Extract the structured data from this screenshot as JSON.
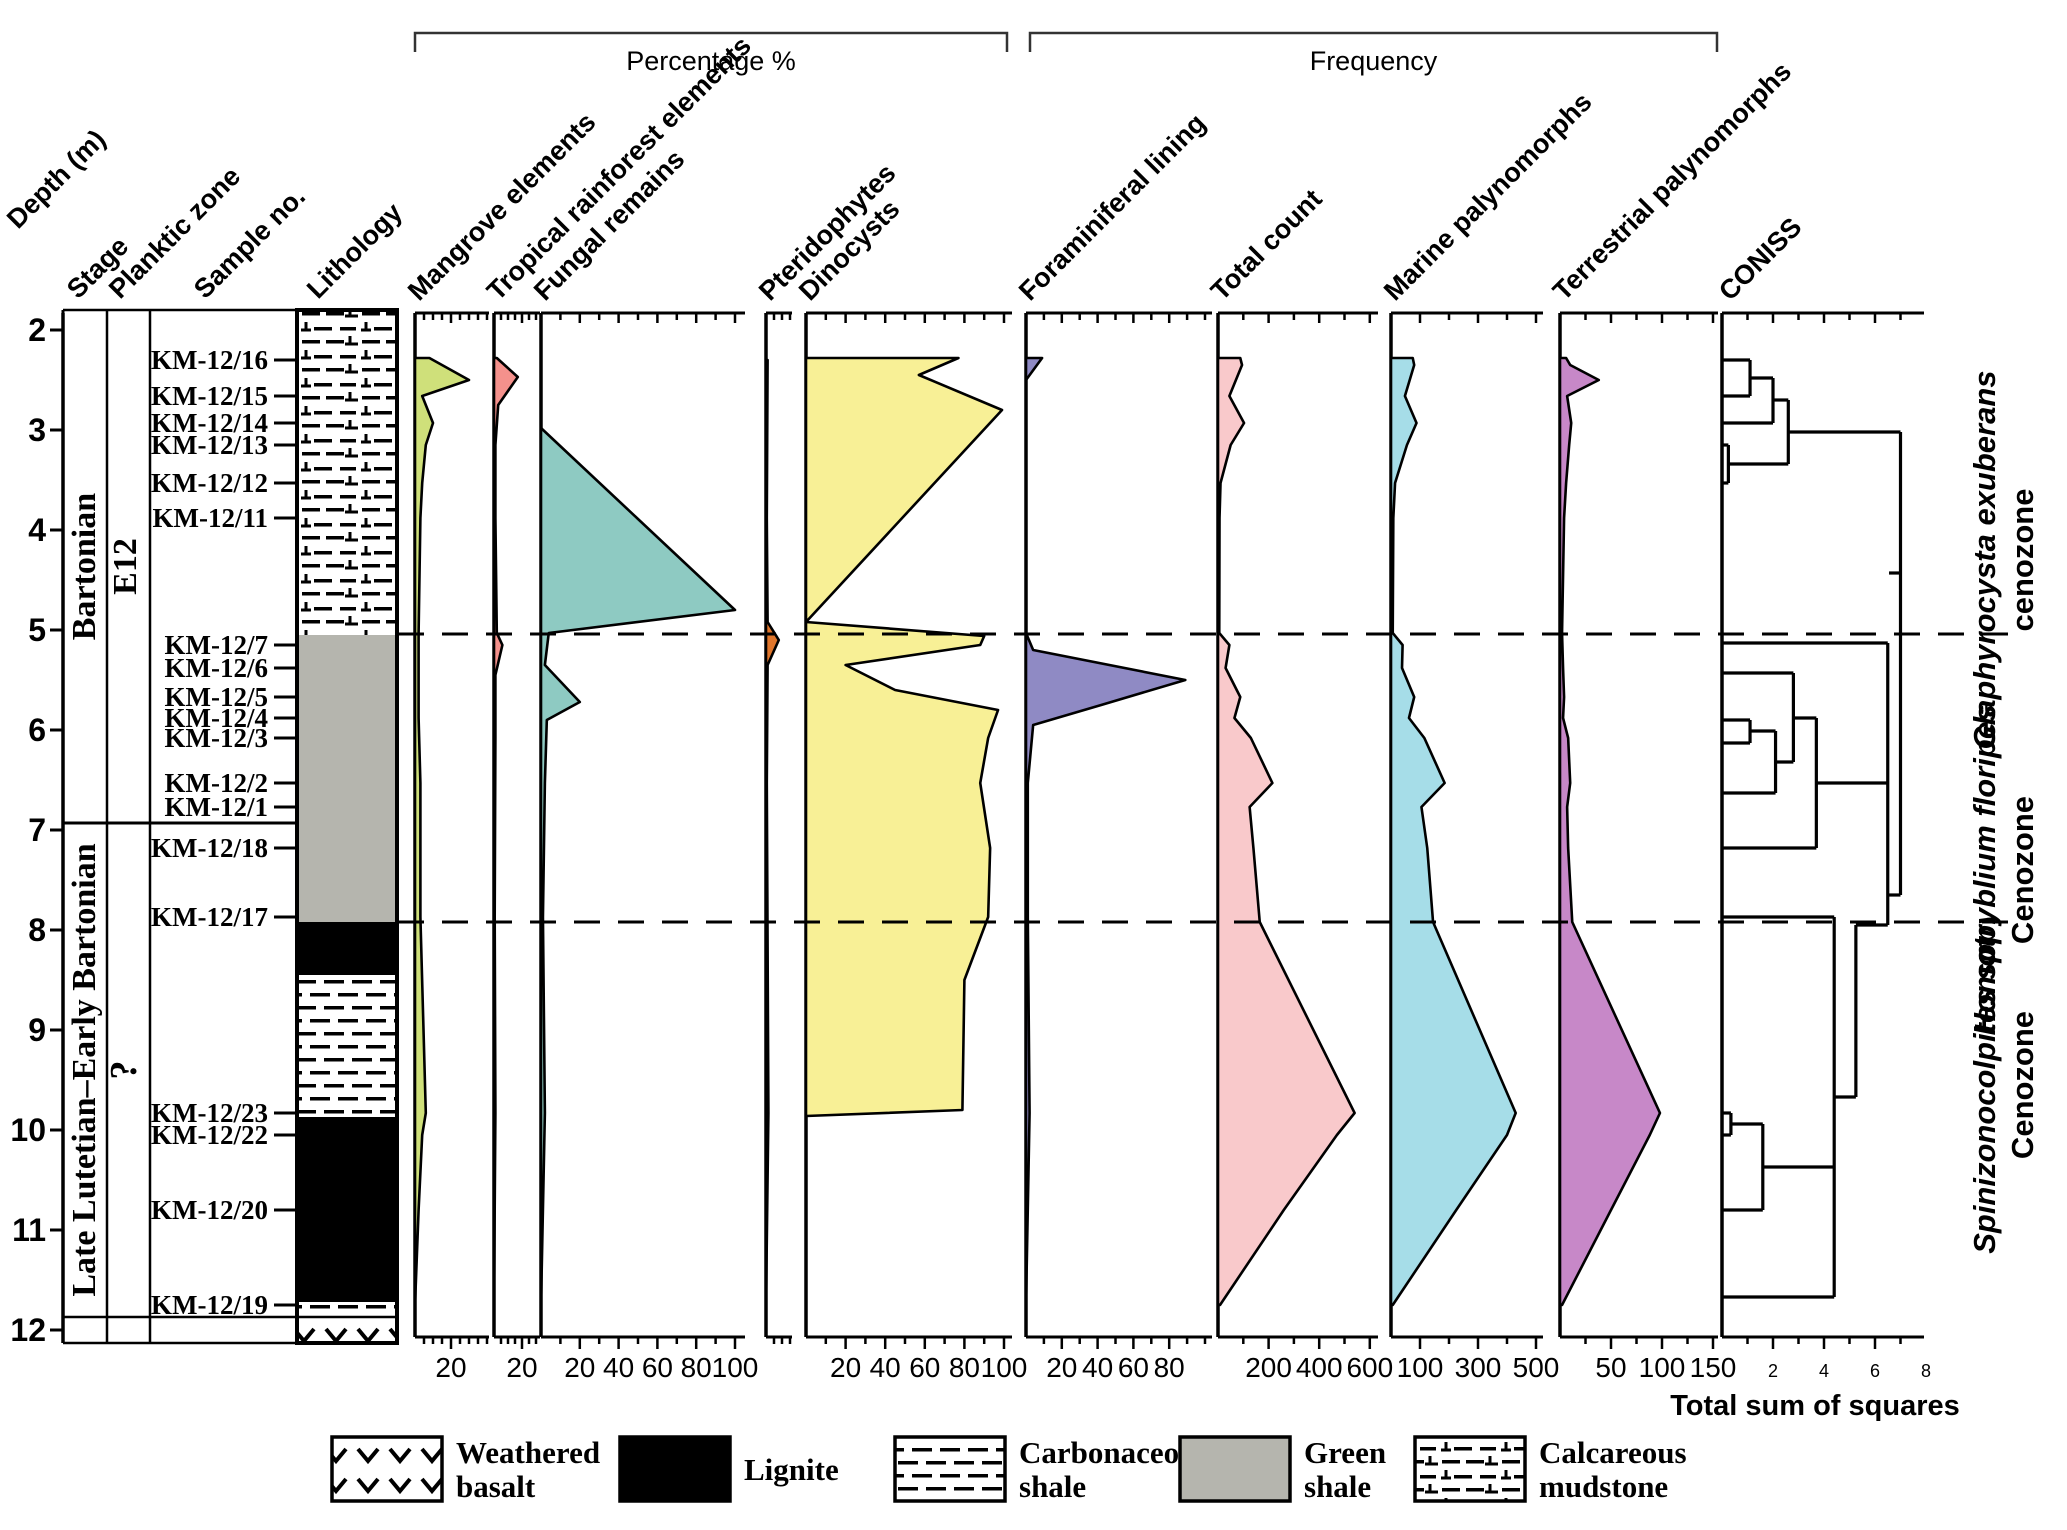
{
  "figure": {
    "width": 2067,
    "height": 1530,
    "depth_axis": {
      "header": "Depth (m)",
      "unit": "m",
      "min": 2,
      "max": 12,
      "ticks": [
        2,
        3,
        4,
        5,
        6,
        7,
        8,
        9,
        10,
        11,
        12
      ]
    },
    "columns": {
      "stage": {
        "header": "Stage",
        "zones": [
          {
            "label": "Bartonian",
            "from": 1.8,
            "to": 6.93
          },
          {
            "label": "Late Lutetian–Early Bartonian",
            "from": 6.93,
            "to": 12.07
          }
        ]
      },
      "planktic": {
        "header": "Planktic zone",
        "zones": [
          {
            "label": "E12",
            "from": 1.8,
            "to": 6.93
          },
          {
            "label": "?",
            "from": 6.93,
            "to": 12.07
          }
        ]
      },
      "samples": {
        "header": "Sample no.",
        "items": [
          {
            "label": "KM-12/16",
            "depth": 2.3
          },
          {
            "label": "KM-12/15",
            "depth": 2.66
          },
          {
            "label": "KM-12/14",
            "depth": 2.93
          },
          {
            "label": "KM-12/13",
            "depth": 3.15
          },
          {
            "label": "KM-12/12",
            "depth": 3.53
          },
          {
            "label": "KM-12/11",
            "depth": 3.88
          },
          {
            "label": "KM-12/7",
            "depth": 5.15
          },
          {
            "label": "KM-12/6",
            "depth": 5.38
          },
          {
            "label": "KM-12/5",
            "depth": 5.67
          },
          {
            "label": "KM-12/4",
            "depth": 5.88
          },
          {
            "label": "KM-12/3",
            "depth": 6.08
          },
          {
            "label": "KM-12/2",
            "depth": 6.53
          },
          {
            "label": "KM-12/1",
            "depth": 6.77
          },
          {
            "label": "KM-12/18",
            "depth": 7.18
          },
          {
            "label": "KM-12/17",
            "depth": 7.87
          },
          {
            "label": "KM-12/23",
            "depth": 9.83
          },
          {
            "label": "KM-12/22",
            "depth": 10.05
          },
          {
            "label": "KM-12/20",
            "depth": 10.8
          },
          {
            "label": "KM-12/19",
            "depth": 11.75
          }
        ]
      },
      "lithology": {
        "header": "Lithology",
        "units": [
          {
            "type": "calcareous-mudstone",
            "from": 1.8,
            "to": 5.05
          },
          {
            "type": "green-shale",
            "from": 5.05,
            "to": 7.92
          },
          {
            "type": "lignite",
            "from": 7.92,
            "to": 8.45
          },
          {
            "type": "carbonaceous-shale",
            "from": 8.45,
            "to": 9.87
          },
          {
            "type": "lignite",
            "from": 9.87,
            "to": 11.72
          },
          {
            "type": "carbonaceous-shale",
            "from": 11.72,
            "to": 11.87
          },
          {
            "type": "weathered-basalt",
            "from": 11.87,
            "to": 12.13
          }
        ]
      }
    },
    "brackets": [
      {
        "label": "Percentage %",
        "x1": 415,
        "x2": 1007
      },
      {
        "label": "Frequency",
        "x1": 1030,
        "x2": 1717
      }
    ],
    "dashed_line_depths": [
      5.04,
      7.92
    ],
    "cenozones": [
      {
        "line1": "Glaphyrocysta exuberans",
        "line2": "cenozone",
        "center_depth": 4.3
      },
      {
        "line1": "Homotryblium floripes",
        "line2": "Cenozone",
        "center_depth": 7.4
      },
      {
        "line1": "Spinizonocolpites spp.",
        "line2": "Cenozone",
        "center_depth": 9.55
      }
    ],
    "colors": {
      "green_shale": "#b5b5ae",
      "lignite": "#000000",
      "stroke": "#000000"
    }
  },
  "chart_data": {
    "type": "area",
    "title": "Palynological distribution chart with lithology, percentage and frequency curves and CONISS dendrogram",
    "x_axis_groups": [
      "Percentage %",
      "Frequency"
    ],
    "depth_unit": "m",
    "depth_range": [
      2,
      12
    ],
    "panels": [
      {
        "name": "Mangrove elements",
        "group": "Percentage %",
        "color": "#cfe07a",
        "x": 415,
        "width": 74,
        "px_per_unit": 1.8,
        "tick_labels": [
          20
        ],
        "minor_step": 5,
        "points": [
          [
            2.28,
            8
          ],
          [
            2.5,
            30
          ],
          [
            2.66,
            4
          ],
          [
            2.93,
            10
          ],
          [
            3.15,
            6
          ],
          [
            3.53,
            4
          ],
          [
            3.88,
            3
          ],
          [
            5.03,
            2
          ],
          [
            5.38,
            2
          ],
          [
            5.88,
            2
          ],
          [
            6.53,
            3
          ],
          [
            7.18,
            3
          ],
          [
            7.87,
            3
          ],
          [
            9.83,
            6
          ],
          [
            10.05,
            4
          ],
          [
            10.8,
            2
          ],
          [
            11.75,
            0
          ]
        ]
      },
      {
        "name": "Tropical rainforest elements",
        "group": "Percentage %",
        "color": "#f4918c",
        "x": 494,
        "width": 46,
        "px_per_unit": 1.4,
        "tick_labels": [
          20
        ],
        "minor_step": 5,
        "points": [
          [
            2.28,
            2
          ],
          [
            2.47,
            17
          ],
          [
            2.75,
            3
          ],
          [
            3.15,
            1
          ],
          [
            3.88,
            1
          ],
          [
            5.03,
            2
          ],
          [
            5.15,
            6
          ],
          [
            5.45,
            1
          ],
          [
            6.08,
            1
          ],
          [
            7.87,
            0.5
          ],
          [
            9.83,
            1
          ],
          [
            11.75,
            0
          ]
        ]
      },
      {
        "name": "Fungal remains",
        "group": "Percentage %",
        "color": "#8ecac2",
        "x": 541,
        "width": 204,
        "px_per_unit": 1.94,
        "tick_labels": [
          20,
          40,
          60,
          80,
          100
        ],
        "minor_step": 10,
        "points": [
          [
            2.98,
            0
          ],
          [
            4.8,
            100
          ],
          [
            5.03,
            4
          ],
          [
            5.35,
            2
          ],
          [
            5.72,
            20
          ],
          [
            5.9,
            3
          ],
          [
            6.53,
            2
          ],
          [
            7.87,
            1
          ],
          [
            9.83,
            2
          ],
          [
            11.75,
            0
          ]
        ]
      },
      {
        "name": "Pteridophytes",
        "group": "Percentage %",
        "color": "#e0762c",
        "x": 766,
        "width": 26,
        "px_per_unit": 1.6,
        "tick_labels": [],
        "minor_step": 5,
        "points": [
          [
            2.3,
            1
          ],
          [
            3.88,
            0.5
          ],
          [
            4.92,
            1
          ],
          [
            5.1,
            8
          ],
          [
            5.35,
            1
          ],
          [
            6.53,
            0.5
          ],
          [
            9.83,
            1.5
          ],
          [
            11.75,
            0
          ]
        ]
      },
      {
        "name": "Dinocysts",
        "group": "Percentage %",
        "color": "#f8f096",
        "x": 806,
        "width": 206,
        "px_per_unit": 1.98,
        "tick_labels": [
          20,
          40,
          60,
          80,
          100
        ],
        "minor_step": 10,
        "points": [
          [
            2.28,
            77
          ],
          [
            2.45,
            57
          ],
          [
            2.8,
            99
          ],
          [
            4.92,
            0
          ],
          [
            5.06,
            90
          ],
          [
            5.15,
            88
          ],
          [
            5.35,
            20
          ],
          [
            5.6,
            45
          ],
          [
            5.8,
            97
          ],
          [
            6.08,
            92
          ],
          [
            6.53,
            88
          ],
          [
            7.18,
            93
          ],
          [
            7.87,
            92
          ],
          [
            8.5,
            80
          ],
          [
            9.8,
            79
          ],
          [
            9.86,
            0
          ]
        ]
      },
      {
        "name": "Foraminiferal lining",
        "group": "Frequency",
        "color": "#8f8ac4",
        "x": 1026,
        "width": 186,
        "px_per_unit": 1.79,
        "tick_labels": [
          20,
          40,
          60,
          80
        ],
        "minor_step": 10,
        "points": [
          [
            2.28,
            9
          ],
          [
            2.5,
            0
          ],
          [
            5.03,
            0
          ],
          [
            5.2,
            4
          ],
          [
            5.5,
            89
          ],
          [
            5.75,
            42
          ],
          [
            5.95,
            4
          ],
          [
            6.53,
            1
          ],
          [
            7.87,
            1
          ],
          [
            9.83,
            2
          ],
          [
            11.75,
            0
          ]
        ]
      },
      {
        "name": "Total count",
        "group": "Frequency",
        "color": "#f9c9cb",
        "x": 1218,
        "width": 160,
        "px_per_unit": 0.253,
        "tick_labels": [
          200,
          400,
          600
        ],
        "minor_step": 100,
        "points": [
          [
            2.28,
            88
          ],
          [
            2.35,
            95
          ],
          [
            2.66,
            45
          ],
          [
            2.93,
            103
          ],
          [
            3.15,
            50
          ],
          [
            3.53,
            10
          ],
          [
            3.88,
            6
          ],
          [
            5.03,
            5
          ],
          [
            5.15,
            45
          ],
          [
            5.38,
            30
          ],
          [
            5.67,
            88
          ],
          [
            5.88,
            65
          ],
          [
            6.08,
            130
          ],
          [
            6.53,
            215
          ],
          [
            6.77,
            125
          ],
          [
            7.18,
            140
          ],
          [
            7.92,
            165
          ],
          [
            9.83,
            540
          ],
          [
            10.05,
            470
          ],
          [
            10.8,
            260
          ],
          [
            11.75,
            8
          ]
        ]
      },
      {
        "name": "Marine palynomorphs",
        "group": "Frequency",
        "color": "#a6dde8",
        "x": 1391,
        "width": 152,
        "px_per_unit": 0.29,
        "tick_labels": [
          100,
          300,
          500
        ],
        "minor_step": 100,
        "points": [
          [
            2.28,
            75
          ],
          [
            2.35,
            80
          ],
          [
            2.66,
            48
          ],
          [
            2.93,
            88
          ],
          [
            3.15,
            55
          ],
          [
            3.53,
            14
          ],
          [
            3.88,
            8
          ],
          [
            5.03,
            6
          ],
          [
            5.15,
            40
          ],
          [
            5.38,
            38
          ],
          [
            5.67,
            80
          ],
          [
            5.88,
            62
          ],
          [
            6.08,
            115
          ],
          [
            6.53,
            185
          ],
          [
            6.77,
            105
          ],
          [
            7.18,
            125
          ],
          [
            7.92,
            145
          ],
          [
            9.83,
            430
          ],
          [
            10.05,
            400
          ],
          [
            10.8,
            225
          ],
          [
            11.75,
            6
          ]
        ]
      },
      {
        "name": "Terrestrial palynomorphs",
        "group": "Frequency",
        "color": "#c788c8",
        "x": 1560,
        "width": 158,
        "px_per_unit": 1.02,
        "tick_labels": [
          50,
          100,
          150
        ],
        "minor_step": 25,
        "points": [
          [
            2.28,
            6
          ],
          [
            2.35,
            10
          ],
          [
            2.5,
            38
          ],
          [
            2.66,
            7
          ],
          [
            2.93,
            11
          ],
          [
            3.15,
            9
          ],
          [
            3.53,
            6
          ],
          [
            3.88,
            4
          ],
          [
            5.03,
            2
          ],
          [
            5.38,
            3
          ],
          [
            5.67,
            4
          ],
          [
            5.88,
            3
          ],
          [
            6.08,
            8
          ],
          [
            6.53,
            10
          ],
          [
            6.77,
            7
          ],
          [
            7.18,
            8
          ],
          [
            7.92,
            12
          ],
          [
            9.83,
            98
          ],
          [
            10.05,
            88
          ],
          [
            10.8,
            50
          ],
          [
            11.75,
            2
          ]
        ]
      }
    ],
    "coniss": {
      "name": "CONISS",
      "xlabel": "Total sum of squares",
      "x": 1722,
      "width": 202,
      "px_per_unit": 25.5,
      "tick_labels": [
        2,
        4,
        6,
        8
      ],
      "minor_step": 1,
      "segments": [
        [
          0,
          2.3,
          1.1,
          2.3
        ],
        [
          0,
          2.66,
          1.1,
          2.66
        ],
        [
          1.1,
          2.3,
          1.1,
          2.66
        ],
        [
          1.1,
          2.48,
          2.0,
          2.48
        ],
        [
          0,
          2.93,
          2.0,
          2.93
        ],
        [
          2.0,
          2.48,
          2.0,
          2.93
        ],
        [
          0,
          3.15,
          0.25,
          3.15
        ],
        [
          0,
          3.53,
          0.25,
          3.53
        ],
        [
          0.25,
          3.15,
          0.25,
          3.53
        ],
        [
          2.0,
          2.7,
          2.6,
          2.7
        ],
        [
          0.25,
          3.34,
          2.6,
          3.34
        ],
        [
          2.6,
          2.7,
          2.6,
          3.34
        ],
        [
          2.6,
          3.02,
          7.0,
          3.02
        ],
        [
          7.0,
          3.02,
          7.0,
          7.65
        ],
        [
          6.5,
          7.65,
          7.0,
          7.65
        ],
        [
          6.55,
          4.43,
          7.0,
          4.43
        ],
        [
          0,
          5.13,
          6.5,
          5.13
        ],
        [
          6.5,
          5.13,
          6.5,
          7.95
        ],
        [
          0,
          5.43,
          2.8,
          5.43
        ],
        [
          2.8,
          5.43,
          2.8,
          6.32
        ],
        [
          0,
          5.9,
          1.1,
          5.9
        ],
        [
          0,
          6.13,
          1.1,
          6.13
        ],
        [
          1.1,
          5.9,
          1.1,
          6.13
        ],
        [
          1.1,
          6.01,
          2.1,
          6.01
        ],
        [
          0,
          6.63,
          2.1,
          6.63
        ],
        [
          2.1,
          6.01,
          2.1,
          6.63
        ],
        [
          2.1,
          6.32,
          2.8,
          6.32
        ],
        [
          2.8,
          5.88,
          3.7,
          5.88
        ],
        [
          3.7,
          5.88,
          3.7,
          7.18
        ],
        [
          0,
          7.18,
          3.7,
          7.18
        ],
        [
          3.7,
          6.53,
          6.5,
          6.53
        ],
        [
          5.25,
          7.95,
          6.5,
          7.95
        ],
        [
          5.25,
          7.95,
          5.25,
          9.67
        ],
        [
          4.4,
          9.67,
          5.25,
          9.67
        ],
        [
          0,
          7.87,
          4.4,
          7.87
        ],
        [
          4.4,
          7.87,
          4.4,
          11.67
        ],
        [
          0,
          11.67,
          4.4,
          11.67
        ],
        [
          0,
          9.83,
          0.35,
          9.83
        ],
        [
          0,
          10.05,
          0.35,
          10.05
        ],
        [
          0.35,
          9.83,
          0.35,
          10.05
        ],
        [
          0.35,
          9.94,
          1.6,
          9.94
        ],
        [
          0,
          10.8,
          1.6,
          10.8
        ],
        [
          1.6,
          9.94,
          1.6,
          10.8
        ],
        [
          1.6,
          10.37,
          4.4,
          10.37
        ]
      ]
    }
  },
  "legend": {
    "items": [
      {
        "lines": [
          "Weathered",
          "basalt"
        ],
        "pattern": "weathered-basalt"
      },
      {
        "lines": [
          "Lignite"
        ],
        "pattern": "lignite"
      },
      {
        "lines": [
          "Carbonaceous",
          "shale"
        ],
        "pattern": "carbonaceous-shale"
      },
      {
        "lines": [
          "Green",
          "shale"
        ],
        "pattern": "green-shale"
      },
      {
        "lines": [
          "Calcareous",
          "mudstone"
        ],
        "pattern": "calcareous-mudstone"
      }
    ]
  }
}
